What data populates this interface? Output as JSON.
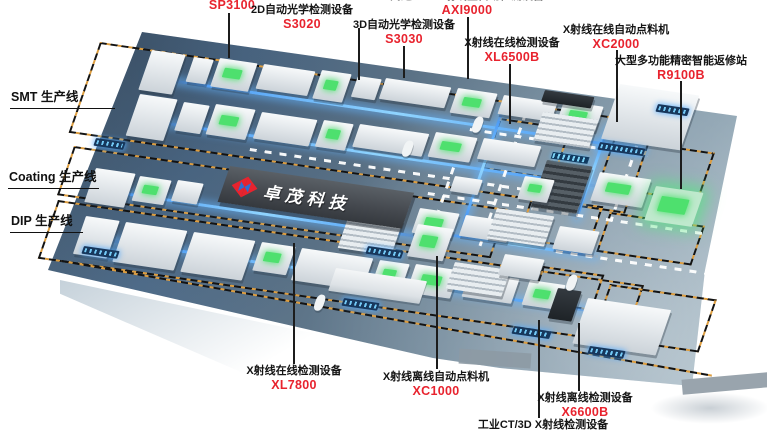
{
  "colors": {
    "accent_red": "#e8232e",
    "label_black": "#141414",
    "floor_dark": "#45596b",
    "floor_light": "#b9cad3",
    "zone_dash_orange": "#dd9d3f",
    "zone_dash_black": "#131313",
    "conveyor_blue": "#8fd4ff",
    "screen_green": "#4ee06e",
    "banner_bg": "#45494f"
  },
  "banner": {
    "company_name": "卓茂科技"
  },
  "line_labels": [
    {
      "label": "SMT 生产线"
    },
    {
      "label": "Coating 生产线"
    },
    {
      "label": "DIP 生产线"
    }
  ],
  "callouts": [
    {
      "name": "",
      "model": "SP3100"
    },
    {
      "name": "2D自动光学检测设备",
      "model": "S3020"
    },
    {
      "name": "3D自动光学检测设备",
      "model": "S3030"
    },
    {
      "name": "高速CT型X射线全自动检测设备",
      "model": "AXI9000"
    },
    {
      "name": "X射线在线检测设备",
      "model": "XL6500B"
    },
    {
      "name": "X射线在线自动点料机",
      "model": "XC2000"
    },
    {
      "name": "大型多功能精密智能返修站",
      "model": "R9100B"
    },
    {
      "name": "X射线在线检测设备",
      "model": "XL7800"
    },
    {
      "name": "X射线离线自动点料机",
      "model": "XC1000"
    },
    {
      "name": "X射线离线检测设备",
      "model": "X6600B"
    },
    {
      "name": "工业CT/3D X射线检测设备",
      "model": ""
    }
  ]
}
